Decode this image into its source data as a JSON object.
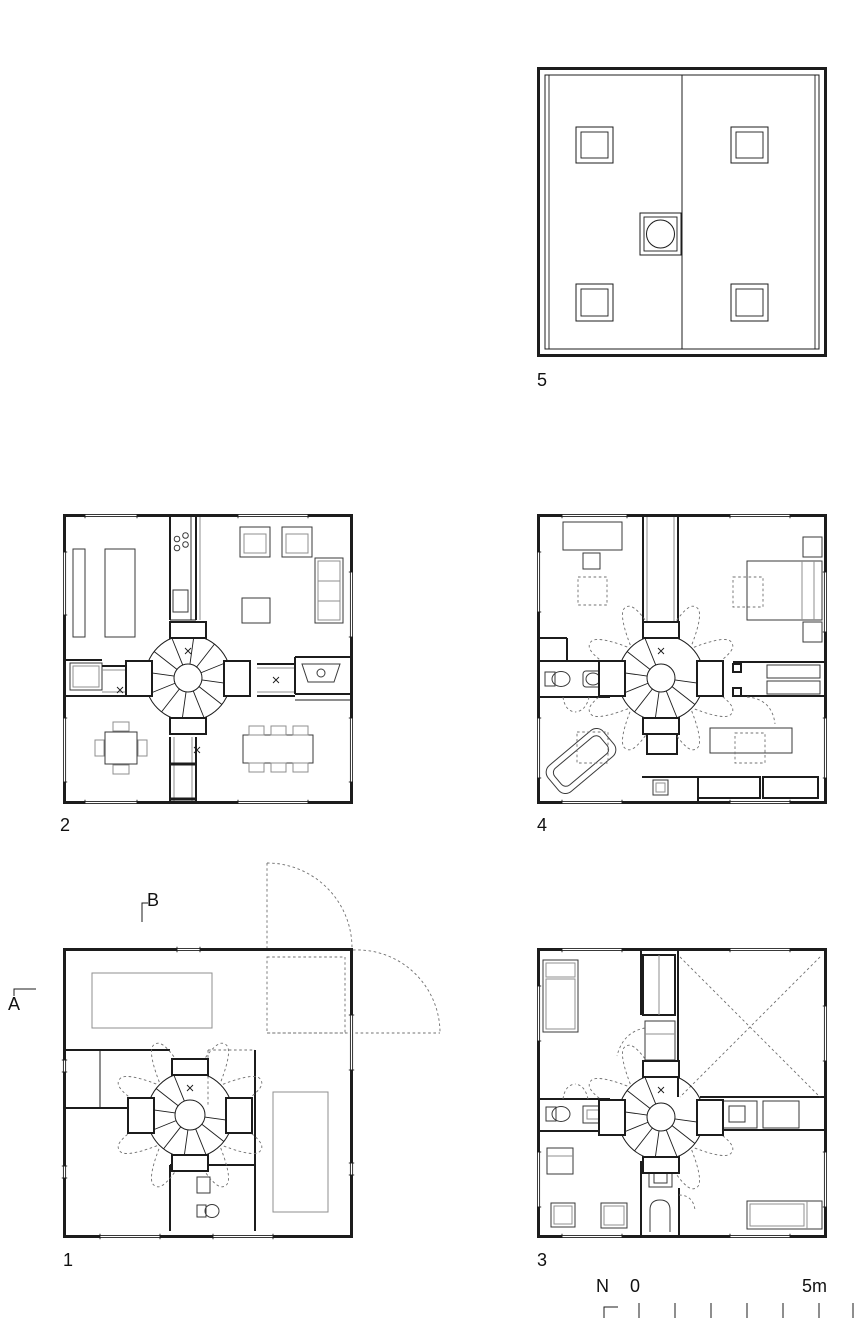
{
  "sheet": {
    "background": "#ffffff",
    "wall_color": "#1c1c1c",
    "furniture_color": "#3a3a3a",
    "light_color": "#8f8f8f",
    "dash_color": "#707070"
  },
  "plans": {
    "p1": {
      "label": "1"
    },
    "p2": {
      "label": "2"
    },
    "p3": {
      "label": "3"
    },
    "p4": {
      "label": "4"
    },
    "p5": {
      "label": "5"
    }
  },
  "sections": {
    "a": "A",
    "b": "B"
  },
  "scale": {
    "north": "N",
    "zero": "0",
    "max": "5m"
  }
}
